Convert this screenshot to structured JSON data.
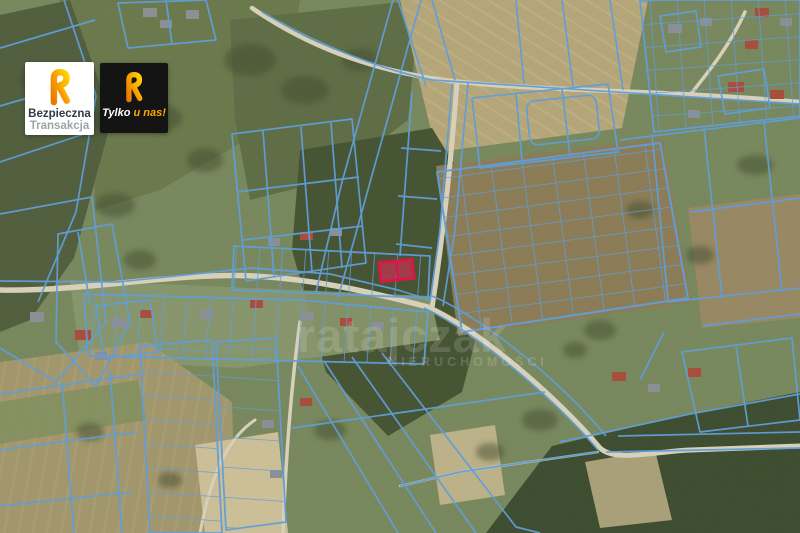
{
  "map": {
    "description": "aerial satellite view with cadastral parcel boundaries",
    "parcel_line_color": "#5d9dd9",
    "highlight_fill": "#ee2456",
    "highlight_stroke": "#dc0f44",
    "highlighted_parcel_cells": 2
  },
  "watermark": {
    "wordmark": "ratajczak",
    "subtitle": "NIERUCHOMOŚCI"
  },
  "badges": {
    "safe_transaction": {
      "line1": "Bezpieczna",
      "line2": "Transakcja"
    },
    "exclusive": {
      "prefix": "Tylko",
      "accent": "u nas!"
    }
  }
}
